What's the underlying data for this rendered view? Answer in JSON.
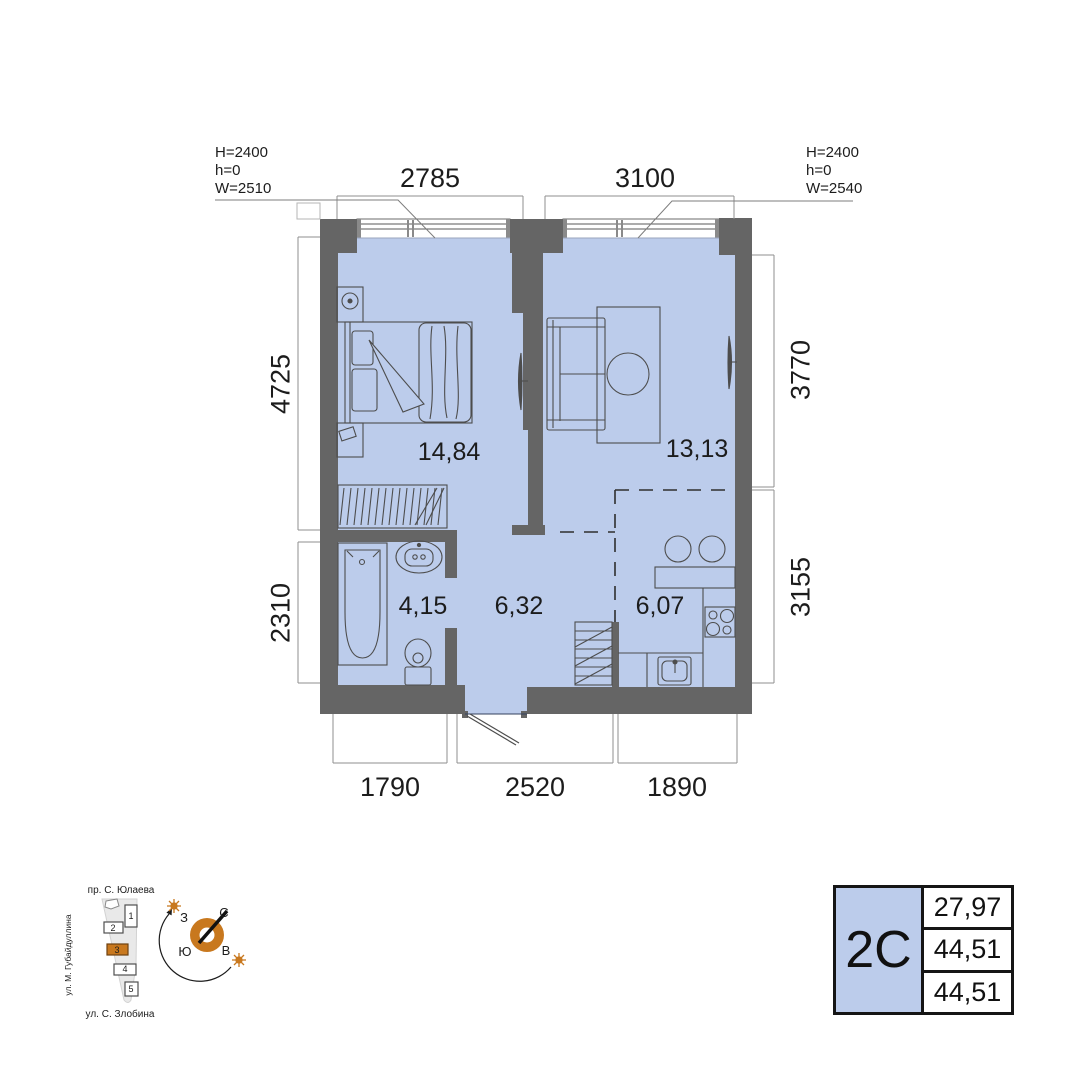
{
  "plan": {
    "dims": {
      "top": [
        "2785",
        "3100"
      ],
      "bottom": [
        "1790",
        "2520",
        "1890"
      ],
      "left": [
        "4725",
        "2310"
      ],
      "right": [
        "3770",
        "3155"
      ]
    },
    "areas": {
      "bedroom": "14,84",
      "living": "13,13",
      "bathroom": "4,15",
      "hall": "6,32",
      "kitchen": "6,07"
    },
    "window_note_left": [
      "H=2400",
      "h=0",
      "W=2510"
    ],
    "window_note_right": [
      "H=2400",
      "h=0",
      "W=2540"
    ]
  },
  "site": {
    "street_top": "пр. С. Юлаева",
    "street_left": "ул. М. Губайдуллина",
    "street_bottom": "ул. С. Злобина",
    "buildings": [
      "1",
      "2",
      "3",
      "4",
      "5"
    ]
  },
  "compass": {
    "north": "С",
    "south": "Ю",
    "west": "З",
    "east": "В"
  },
  "summary_table": {
    "type_label": "2С",
    "values": [
      "27,97",
      "44,51",
      "44,51"
    ]
  },
  "colors": {
    "floor": "#bccceb",
    "wall": "#656565",
    "accent": "#c8781e"
  }
}
